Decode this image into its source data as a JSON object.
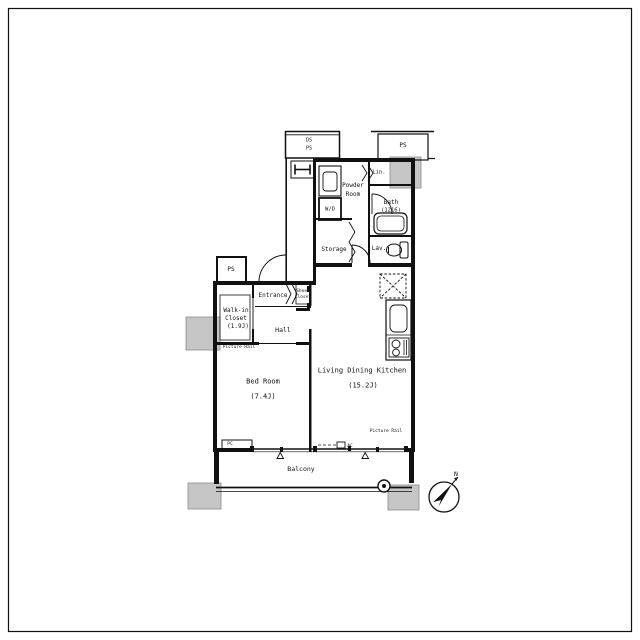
{
  "colors": {
    "line": "#111111",
    "column_fill": "#c6c6c6",
    "background": "#ffffff"
  },
  "rooms": {
    "bed_room": {
      "name": "Bed Room",
      "size": "(7.4J)"
    },
    "living_dining_kitchen": {
      "name": "Living Dining Kitchen",
      "size": "(15.2J)"
    },
    "walk_in_closet": {
      "name_line1": "Walk-in",
      "name_line2": "Closet",
      "size": "(1.9J)"
    },
    "hall": {
      "name": "Hall"
    },
    "entrance": {
      "name": "Entrance"
    },
    "powder_room": {
      "name_line1": "Powder",
      "name_line2": "Room"
    },
    "bath": {
      "name": "Bath",
      "size": "(1216)"
    },
    "storage": {
      "name": "Storage"
    },
    "lavatory": {
      "name": "Lav."
    },
    "balcony": {
      "name": "Balcony"
    }
  },
  "features": {
    "shoes_closet_line1": "Shoes",
    "shoes_closet_line2": "Closet",
    "washer_dryer": "W/D",
    "linen": "Lin.",
    "duct_space": "DS",
    "pipe_space_shaft": "PS",
    "pipe_space_top_right": "PS",
    "pipe_space_entrance": "PS",
    "picture_rail_bedroom": "Picture Rail",
    "picture_rail_ldk": "Picture Rail",
    "counter": "PC",
    "air_conditioner": "AC",
    "compass_north": "N"
  }
}
